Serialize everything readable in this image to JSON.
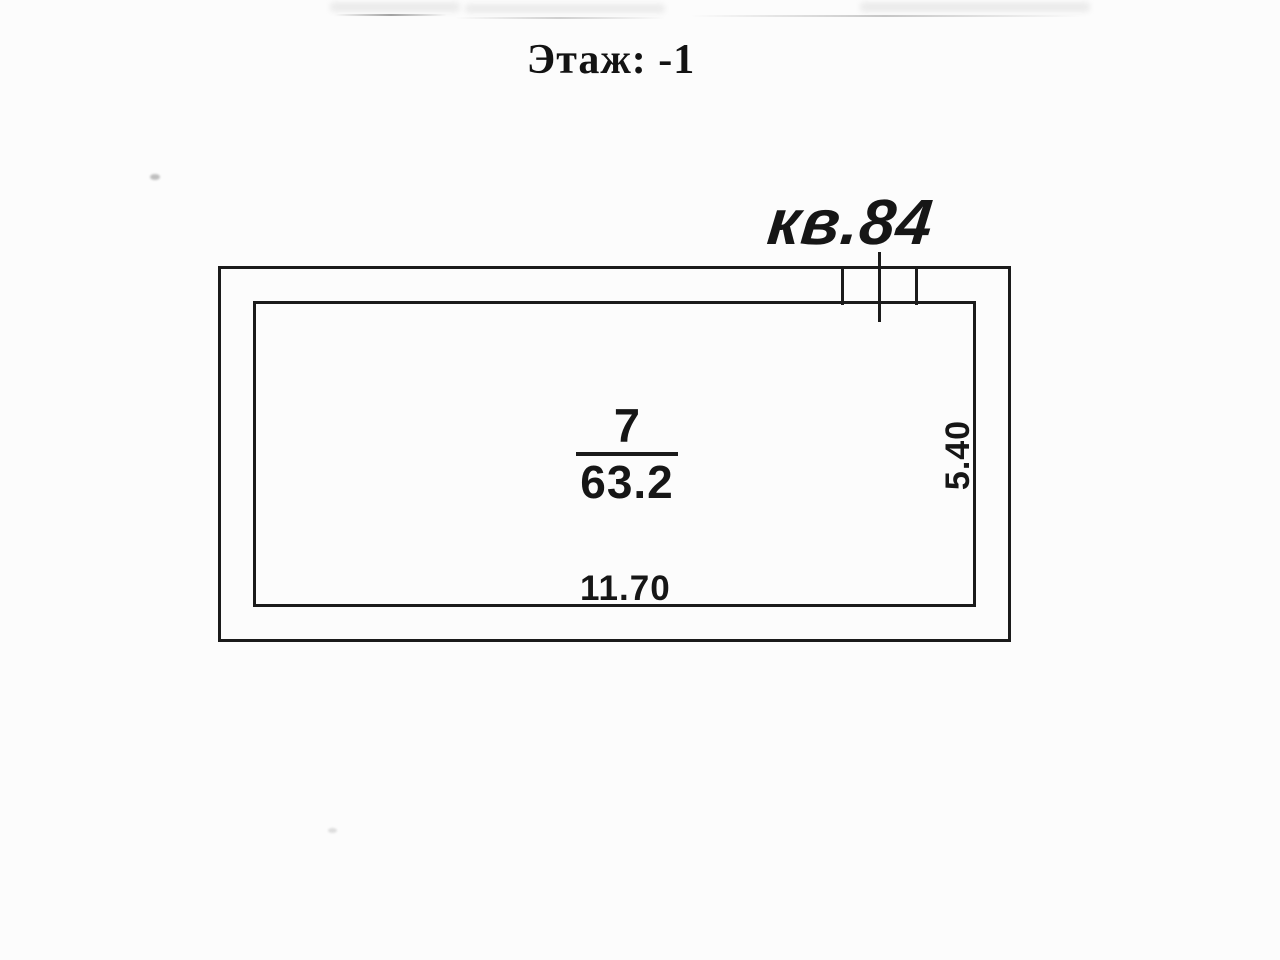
{
  "page": {
    "title": "Этаж: -1"
  },
  "plan": {
    "apartment_label": "кв.84",
    "room": {
      "number": "7",
      "area": "63.2"
    },
    "dimensions": {
      "width": "11.70",
      "height": "5.40"
    }
  },
  "colors": {
    "line": "#1b1b1b",
    "text": "#161616",
    "background": "#fcfcfc",
    "artifact_grey": "#8a8a8a"
  }
}
